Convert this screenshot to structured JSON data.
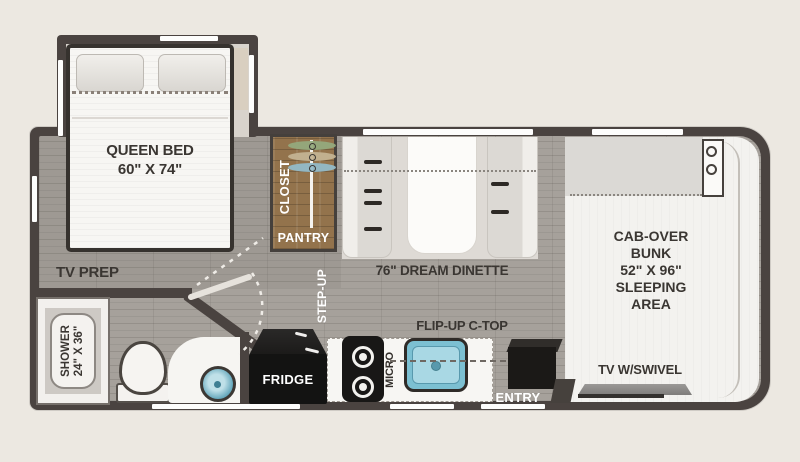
{
  "colors": {
    "background": "#ece8e1",
    "wall": "#4a4340",
    "floor": "#a6a19b",
    "closet_wood": "#93734c",
    "sink_blue": "#7cc0d2",
    "hanger_green": "#93a97c",
    "hanger_tan": "#c3b392",
    "hanger_blue": "#92bac8",
    "label_dark": "#3a3632",
    "label_white": "#ffffff"
  },
  "bedroom": {
    "bed_line1": "QUEEN BED",
    "bed_line2": "60\" X 74\"",
    "tv_prep": "TV PREP"
  },
  "closet": {
    "closet_label": "CLOSET",
    "pantry_label": "PANTRY"
  },
  "hallway": {
    "step_up": "STEP-UP"
  },
  "dinette": {
    "label": "76\" DREAM DINETTE"
  },
  "bathroom": {
    "shower_line1": "SHOWER",
    "shower_line2": "24\" X 36\""
  },
  "kitchen": {
    "fridge": "FRIDGE",
    "micro": "MICRO",
    "flip_up": "FLIP-UP C-TOP",
    "entry": "ENTRY"
  },
  "cab_over": {
    "line1": "CAB-OVER",
    "line2": "BUNK",
    "line3": "52\" X 96\"",
    "line4": "SLEEPING",
    "line5": "AREA",
    "tv": "TV W/SWIVEL"
  }
}
